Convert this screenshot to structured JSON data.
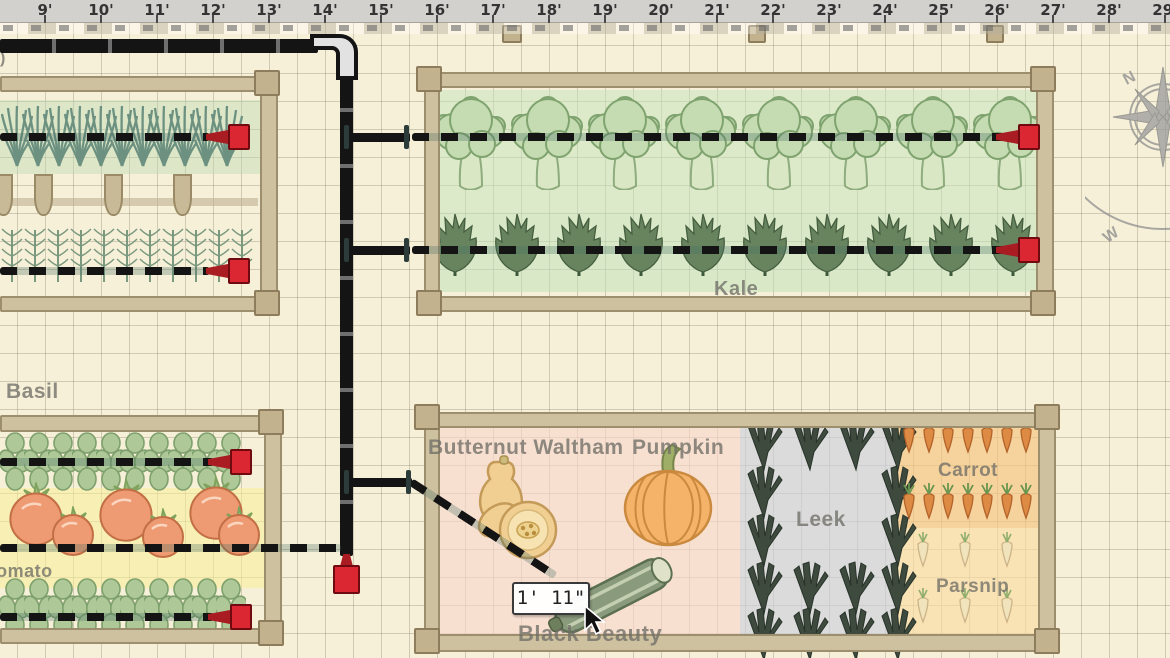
{
  "app": {
    "description": "Garden planner canvas with drip irrigation layout"
  },
  "ruler": {
    "unit": "feet",
    "labels": [
      "9'",
      "10'",
      "11'",
      "12'",
      "13'",
      "14'",
      "15'",
      "16'",
      "17'",
      "18'",
      "19'",
      "20'",
      "21'",
      "22'",
      "23'",
      "24'",
      "25'",
      "26'",
      "27'",
      "28'",
      "29'"
    ]
  },
  "compass": {
    "north_label": "N",
    "west_label": "W"
  },
  "labels": {
    "left_edge_partial": ")",
    "basil": "Basil",
    "tomato": "Tomato",
    "kale": "Kale",
    "butternut": "Butternut Waltham",
    "pumpkin": "Pumpkin",
    "leek": "Leek",
    "carrot": "Carrot",
    "parsnip": "Parsnip",
    "black_beauty": "Black Beauty"
  },
  "measurement_tooltip": {
    "value": "1' 11\""
  },
  "colors": {
    "emitter_red": "#db2731",
    "drip_line": "#141414",
    "bed_wood": "#cec19f",
    "tint_broccoli": "#cde4bc",
    "tint_kale": "#c1e2ba",
    "tint_tomato": "#f7ee96",
    "tint_squash_pink": "#f9d7cd",
    "tint_leek": "#ced0dd",
    "tint_carrot": "#f5c480",
    "tint_parsnip": "#f9dca2",
    "background": "#f7f0d8"
  }
}
